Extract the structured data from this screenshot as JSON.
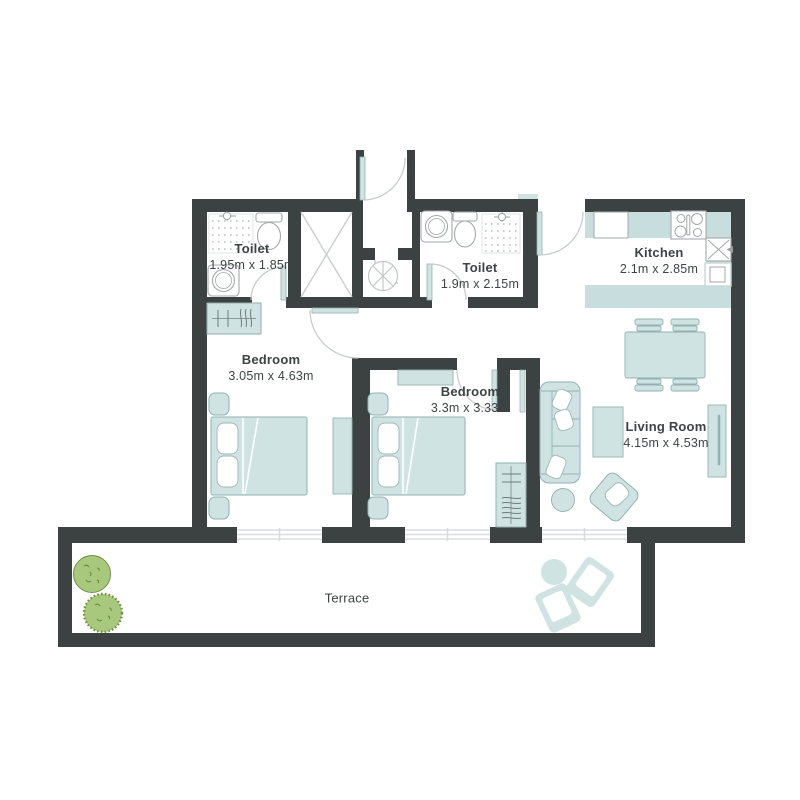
{
  "plan": {
    "type": "apartment-floor-plan",
    "canvas": {
      "width": 800,
      "height": 800,
      "background": "#ffffff"
    },
    "rooms": [
      {
        "id": "toilet-1",
        "name": "Toilet",
        "dimensions": "1.95m x 1.85m"
      },
      {
        "id": "toilet-2",
        "name": "Toilet",
        "dimensions": "1.9m x 2.15m"
      },
      {
        "id": "kitchen",
        "name": "Kitchen",
        "dimensions": "2.1m x 2.85m"
      },
      {
        "id": "bedroom-1",
        "name": "Bedroom",
        "dimensions": "3.05m x 4.63m"
      },
      {
        "id": "bedroom-2",
        "name": "Bedroom",
        "dimensions": "3.3m x 3.33m"
      },
      {
        "id": "living-room",
        "name": "Living Room",
        "dimensions": "4.15m x 4.53m"
      },
      {
        "id": "terrace",
        "name": "Terrace",
        "dimensions": ""
      }
    ],
    "colors": {
      "wall": "#3c4141",
      "furniture_fill": "#cfe3e3",
      "furniture_stroke": "#92b2b2",
      "fixture_stroke": "#a3a8a8",
      "door_arc": "#c4c9c9",
      "window_line": "#d9dddd",
      "plant_fill": "#a8c87e",
      "plant_stroke": "#6d9440",
      "text": "#3e4444"
    }
  }
}
